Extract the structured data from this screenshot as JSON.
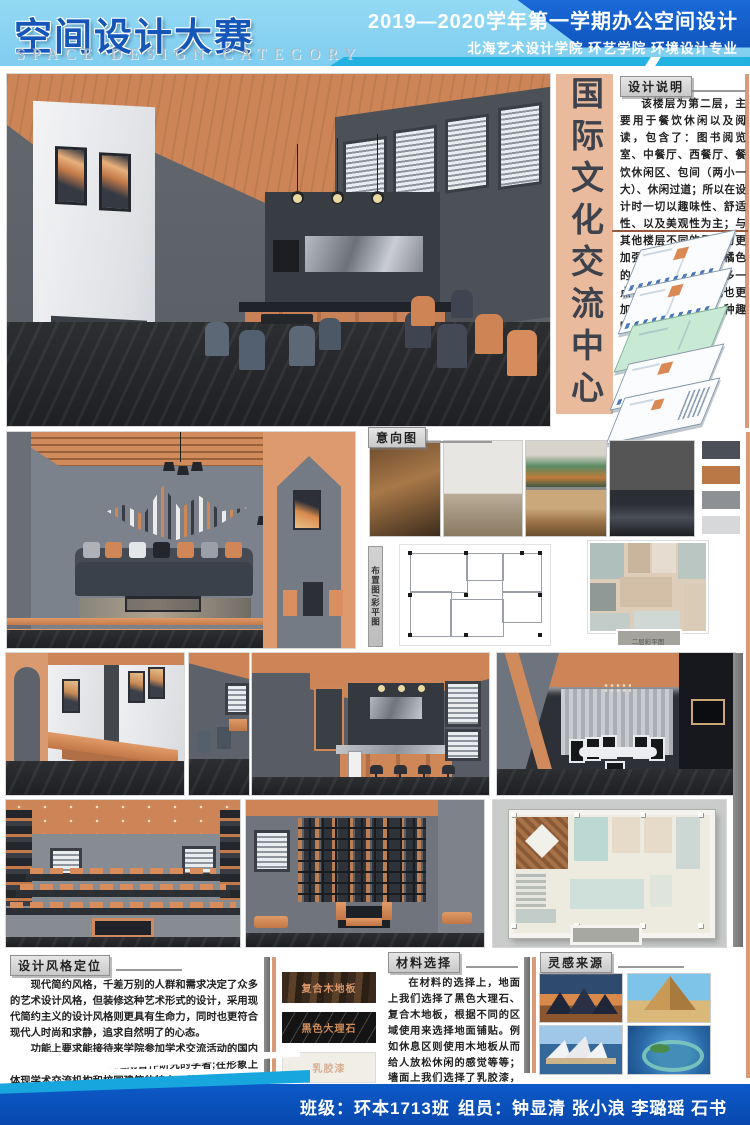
{
  "header": {
    "title": "空间设计大赛",
    "subtitle": "SPACE DESIGN CATEGORY",
    "course_line1": "2019—2020学年第一学期办公空间设计",
    "course_line2": "北海艺术设计学院 环艺学院 环境设计专业"
  },
  "banner": {
    "text": "国际文化交流中心"
  },
  "design_note": {
    "label": "设计说明",
    "body": "该楼层为第二层，主要用于餐饮休闲以及阅读，包含了：图书阅览室、中餐厅、西餐厅、餐饮休闲区、包间（两小一大）、休闲过道；所以在设计时一切以趣味性、舒适性、以及美观性为主；与其他楼层不同的是因为更加强调休闲性，所以橘色的运用就相对来说会多一点，天花吊顶的形式也更加丰富一些，给人一种趣味感。"
  },
  "sections": {
    "mood_label": "意向图",
    "plans_label": "布置图/彩平图",
    "plan_caption": "二层彩平图"
  },
  "style_block": {
    "label": "设计风格定位",
    "p1": "现代简约风格，千差万别的人群和需求决定了众多的艺术设计风格，但装修这种艺术形式的设计，采用现代简约主义的设计风格则更具有生命力，同时也更符合现代人时尚和求静，追求自然明了的心态。",
    "p2": "功能上要求能接待来学院参加学术交流活动的国内外专家团体，以及来校短期合作研究的学者;在形象上体现学术交流机构和校园建筑的特点，营造良好的学术氛围，摒弃商业化的形象。",
    "p3": "同时作为一栋国际交流中心在空间及功能的划分上要求做到松紧对比舒适，色彩选择上要求做到含蓄与彰显充分结合，造型语言上要求做到大小得当、横竖交错合理。"
  },
  "materials": {
    "label": "材料选择",
    "swatches": [
      {
        "label": "复合木地板"
      },
      {
        "label": "黑色大理石"
      },
      {
        "label": "乳胶漆"
      }
    ],
    "body": "在材料的选择上，地面上我们选择了黑色大理石、复合木地板，根据不同的区域使用来选择地面铺贴。例如休息区则使用木地板从而给人放松休闲的感觉等等；墙面上我们选择了乳胶漆，根据不同区域使用不同颜色的乳胶漆，用于区分空间以及简单的装饰作用。"
  },
  "inspiration": {
    "label": "灵感来源"
  },
  "footer": {
    "class_label": "班级：环本1713班",
    "members_label": "组员：钟显清 张小浪 李璐瑶 石书"
  },
  "palette": {
    "header_light_blue": "#8ad4f2",
    "header_dark_blue": "#0d4fb8",
    "teal_accent": "#22b2e2",
    "banner_salmon": "#e9ba9c",
    "accent_orange": "#cd8557",
    "footer_blue": "#0a54c0"
  },
  "mood_palette": [
    "#4b5058",
    "#bb7847",
    "#8d9095",
    "#d7d8da"
  ]
}
